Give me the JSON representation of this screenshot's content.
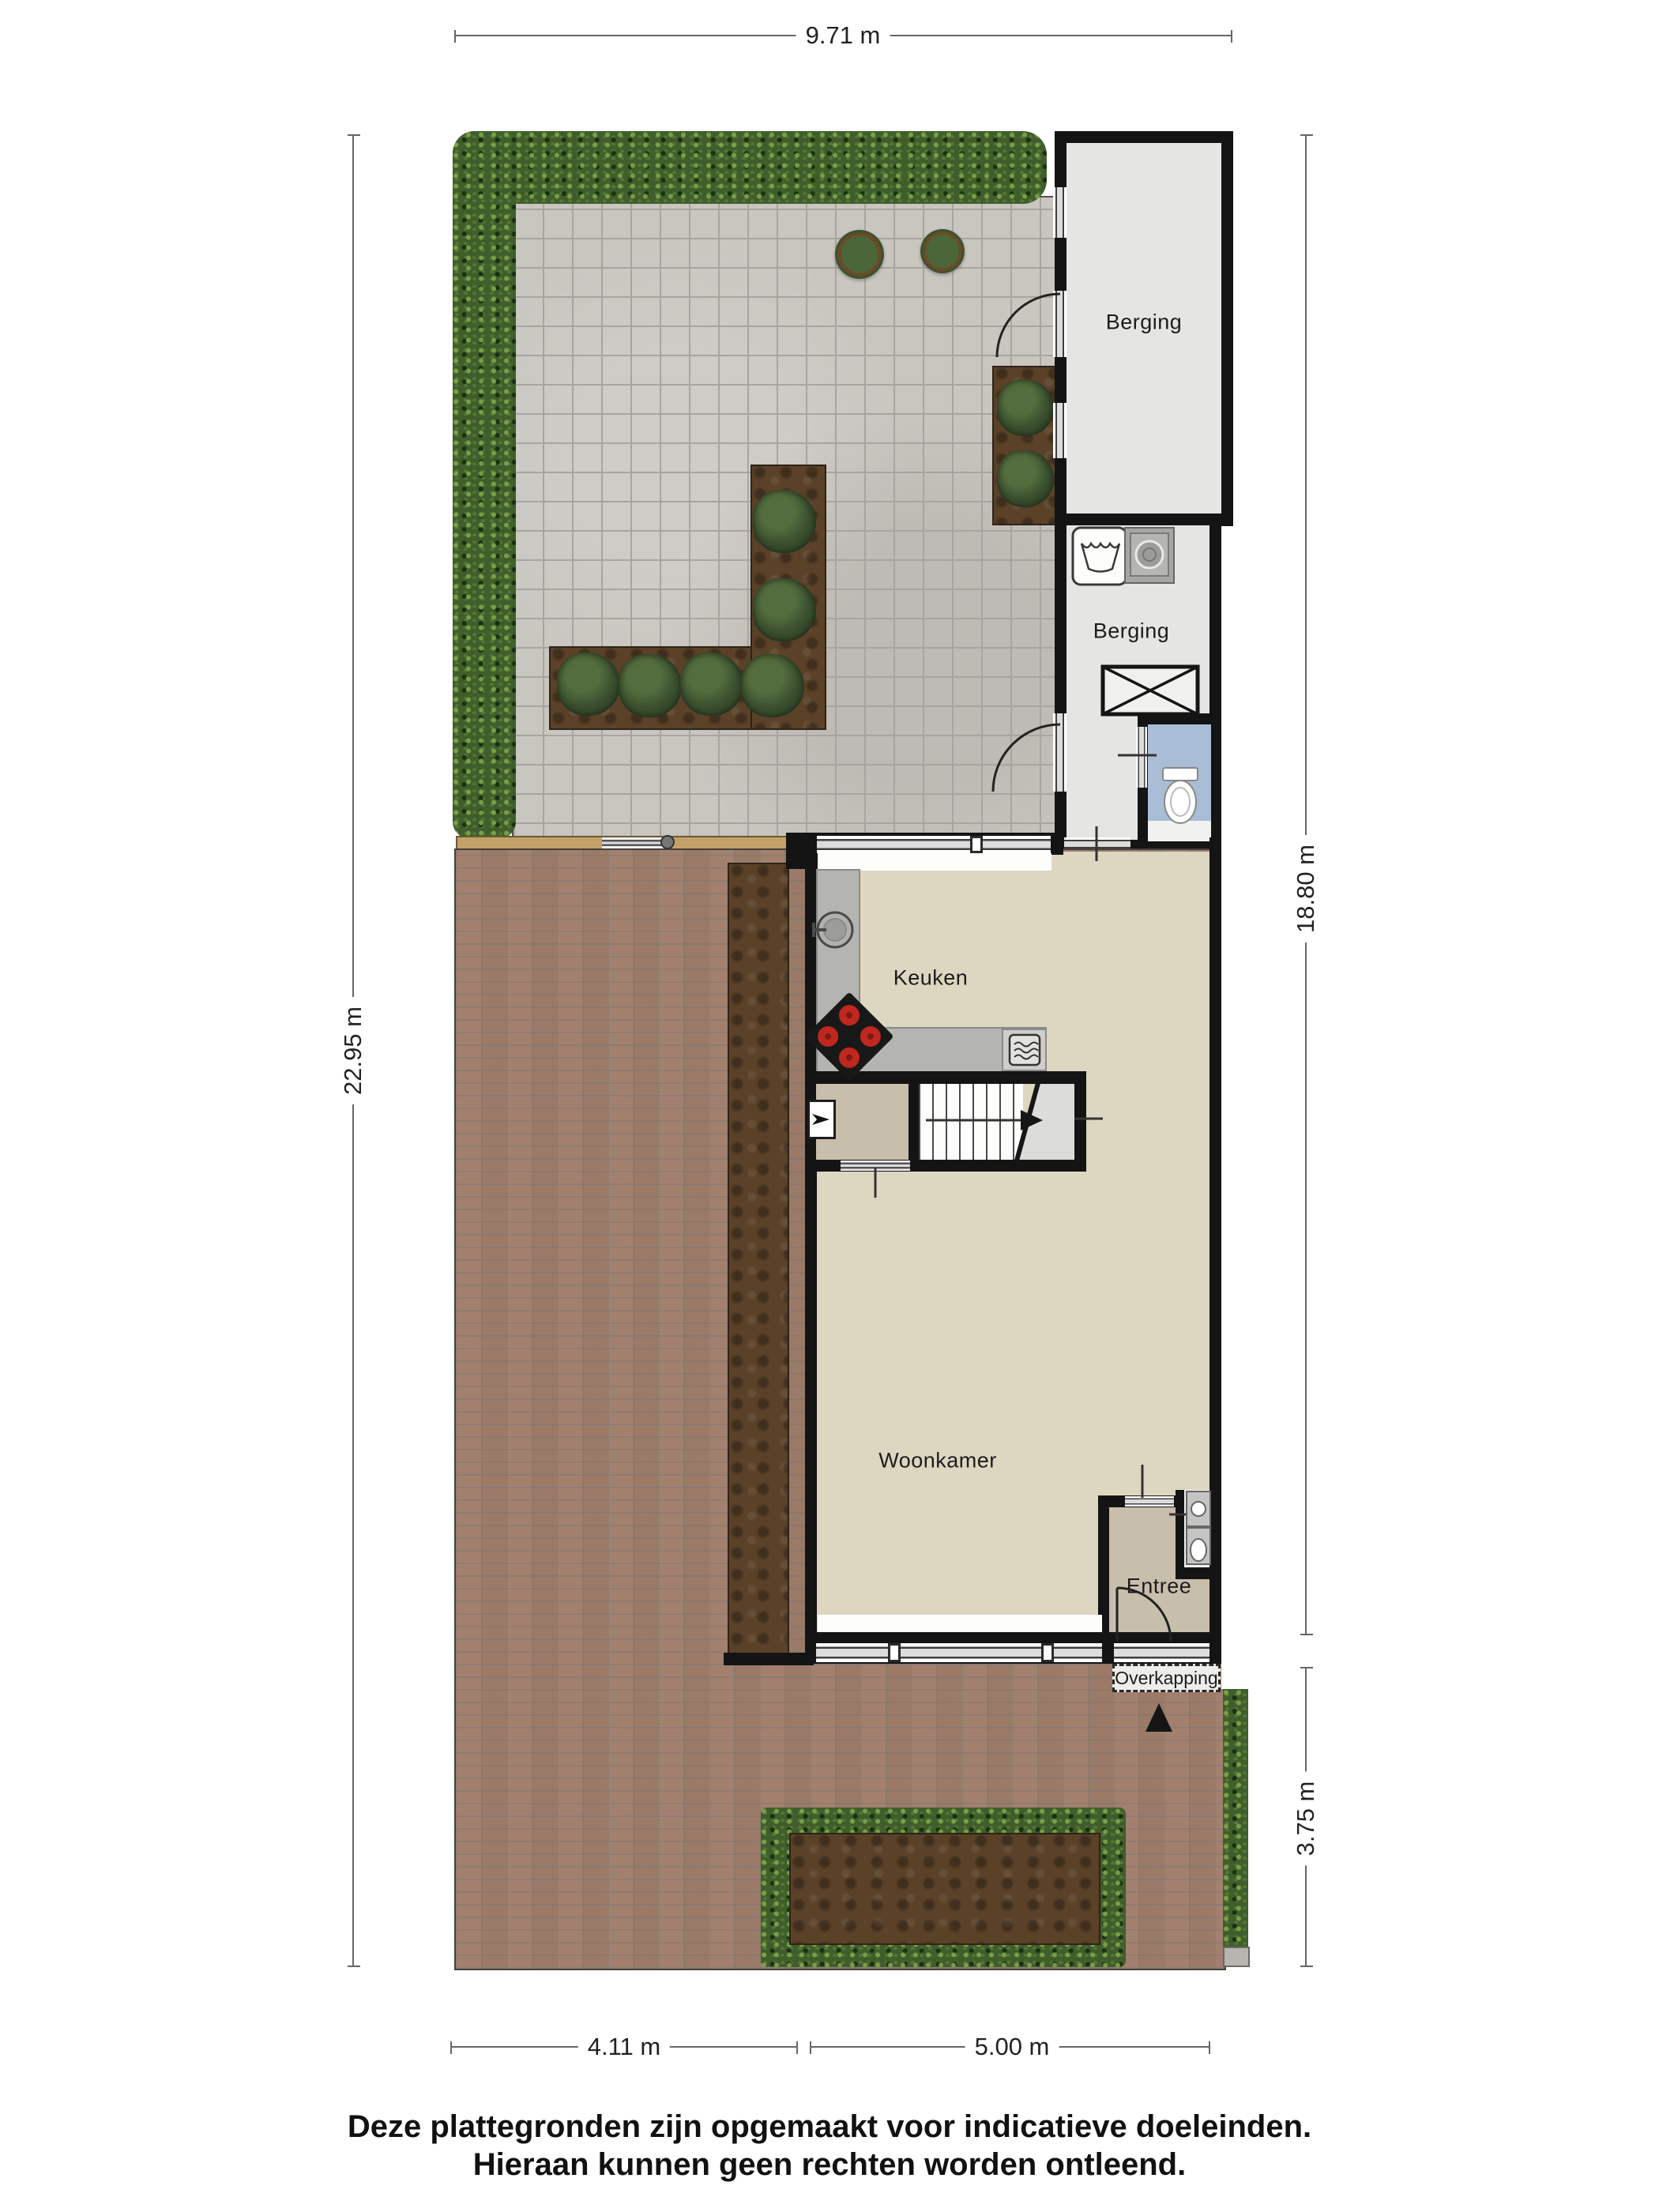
{
  "rooms": {
    "berging_top": "Berging",
    "berging_bottom": "Berging",
    "keuken": "Keuken",
    "kast": "Kast",
    "woonkamer": "Woonkamer",
    "entree": "Entree",
    "overkapping": "Overkapping"
  },
  "dimensions": {
    "top": "9.71 m",
    "left": "22.95 m",
    "right_upper": "18.80 m",
    "right_lower": "3.75 m",
    "bottom_left": "4.11 m",
    "bottom_right": "5.00 m"
  },
  "disclaimer": {
    "line1": "Deze plattegronden zijn opgemaakt voor indicatieve doeleinden.",
    "line2": "Hieraan kunnen geen rechten worden ontleend."
  },
  "colors": {
    "wall": "#141414",
    "terrace_tile": "#c9c6c0",
    "hedge_green": "#3f5e2b",
    "soil_brown": "#5a4128",
    "brick_paving": "#a3806d",
    "floor_living": "#ddd6c1",
    "floor_storage": "#e5e5e3",
    "floor_entree": "#c8beac",
    "floor_toilet": "#a9bdd6",
    "counter_gray": "#b4b4b1",
    "burner_red": "#c0271e"
  },
  "icons": [
    "washing-machine-icon",
    "laundry-sink-icon",
    "toilet-icon",
    "attic-hatch-icon",
    "cooktop-icon",
    "kitchen-sink-icon",
    "oven-icon",
    "stairs-arrow-icon",
    "entrance-arrow-icon",
    "ventilation-unit-icon",
    "washbasin-icon",
    "gate-hinge-icon",
    "shrub-icon",
    "topiary-icon"
  ]
}
